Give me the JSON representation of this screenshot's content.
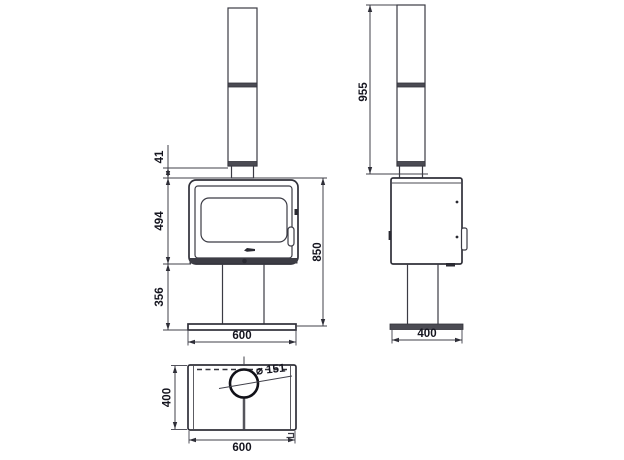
{
  "style": {
    "background": "#ffffff",
    "line_color": "#3b3b44",
    "text_color": "#15151f"
  },
  "views": {
    "front": {
      "label": "front-view",
      "dims": {
        "flue_offset": "41",
        "firebox_height": "494",
        "pedestal_height": "356",
        "overall_height": "850",
        "width": "600"
      }
    },
    "side": {
      "label": "side-view",
      "dims": {
        "height_with_flue": "955",
        "depth": "400"
      }
    },
    "top": {
      "label": "top-view",
      "dims": {
        "depth": "400",
        "width": "600",
        "flue_diameter": "⌀ 151"
      }
    }
  }
}
